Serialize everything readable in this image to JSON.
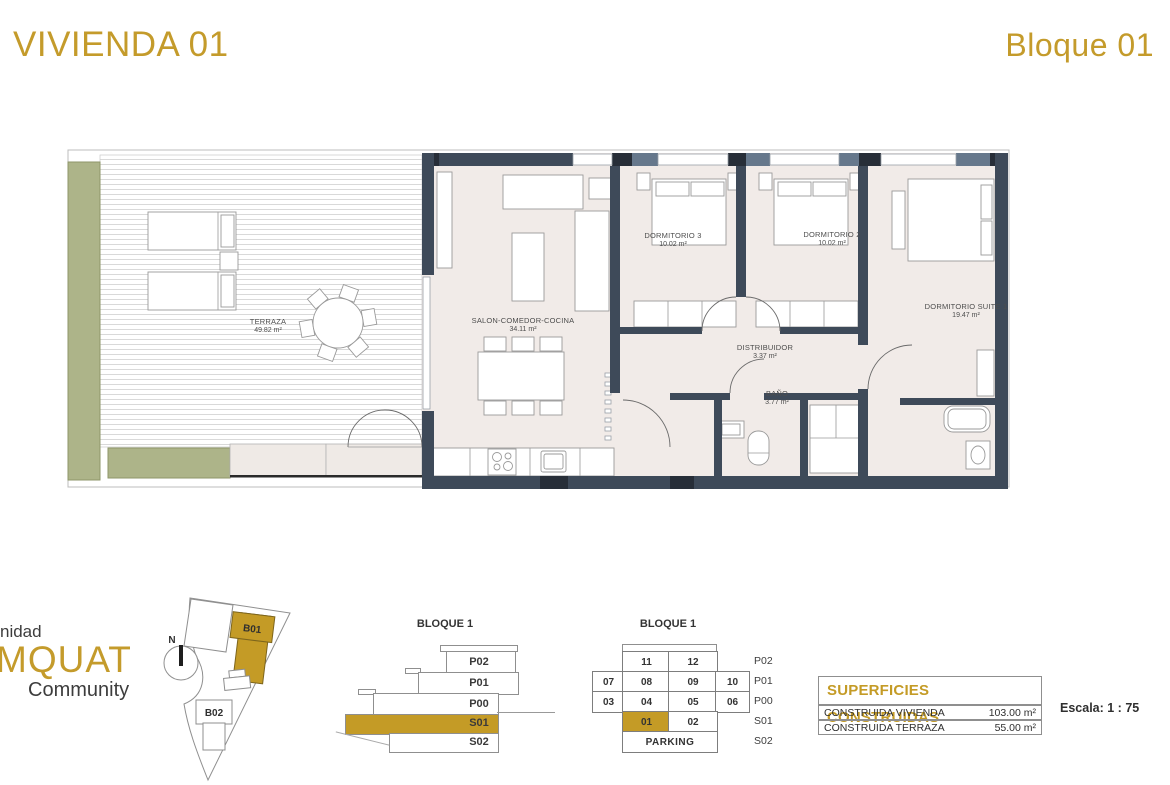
{
  "header": {
    "title": "VIVIENDA 01",
    "block": "Bloque 01"
  },
  "colors": {
    "accent": "#c49b2b",
    "wall": "#3e4a59",
    "planter": "#adb489",
    "floor": "#f1ebe8"
  },
  "floorplan": {
    "rooms": [
      {
        "name": "TERRAZA",
        "area": "49.82 m²"
      },
      {
        "name": "SALON-COMEDOR-COCINA",
        "area": "34.11 m²"
      },
      {
        "name": "DORMITORIO 3",
        "area": "10.02 m²"
      },
      {
        "name": "DORMITORIO 2",
        "area": "10.02 m²"
      },
      {
        "name": "DORMITORIO SUITE 1",
        "area": "19.47 m²"
      },
      {
        "name": "DISTRIBUIDOR",
        "area": "3.37 m²"
      },
      {
        "name": "BAÑO",
        "area": "3.77 m²"
      }
    ]
  },
  "logo": {
    "line1": "nidad",
    "line2": "MQUAT",
    "line3": "Community"
  },
  "siteplan": {
    "north": "N",
    "b01": "B01",
    "b02": "B02"
  },
  "elevation": {
    "title": "BLOQUE 1",
    "floors": [
      "P02",
      "P01",
      "P00",
      "S01",
      "S02"
    ],
    "highlight": "S01"
  },
  "unitgrid": {
    "title": "BLOQUE 1",
    "p02": [
      "11",
      "12"
    ],
    "p01": [
      "07",
      "08",
      "09",
      "10"
    ],
    "p00": [
      "03",
      "04",
      "05",
      "06"
    ],
    "s01": [
      "01",
      "02"
    ],
    "s02_label": "PARKING",
    "row_labels": [
      "P02",
      "P01",
      "P00",
      "S01",
      "S02"
    ],
    "highlight_cell": "01"
  },
  "surfaces": {
    "title": "SUPERFICIES CONSTRUIDAS",
    "rows": [
      {
        "label": "CONSTRUIDA VIVIENDA",
        "value": "103.00 m²"
      },
      {
        "label": "CONSTRUIDA TERRAZA",
        "value": "55.00 m²"
      }
    ],
    "scale": "Escala: 1 : 75"
  }
}
